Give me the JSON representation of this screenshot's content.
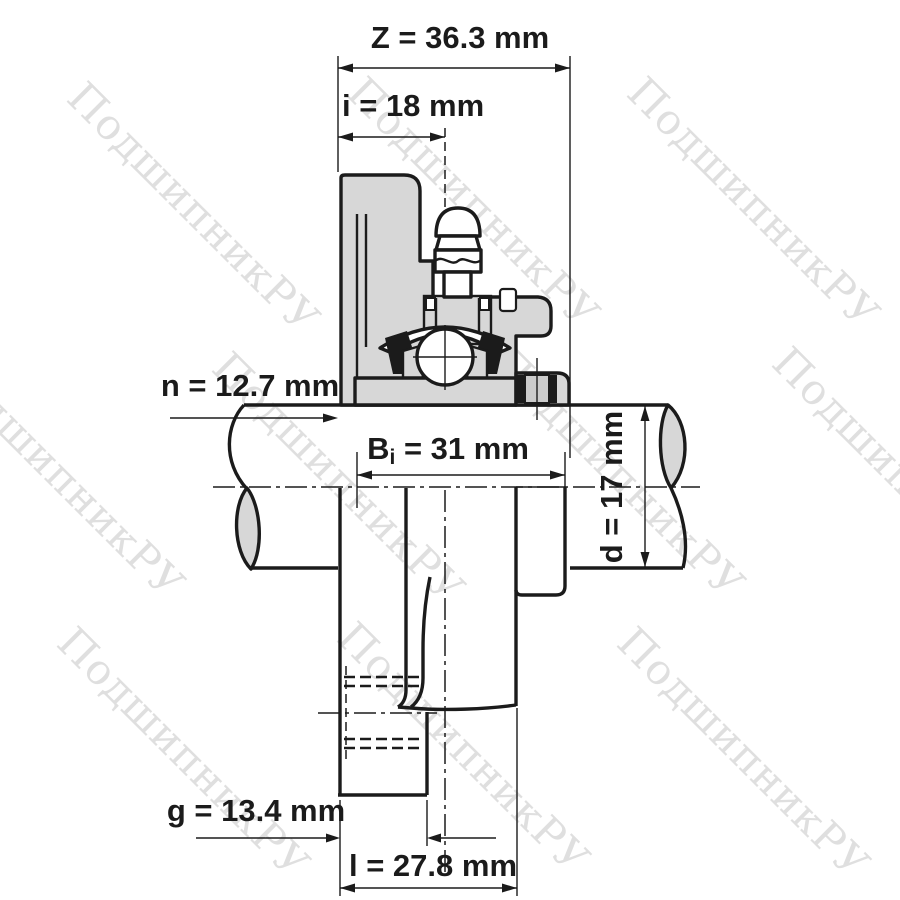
{
  "drawing_title": "Flanged bearing unit cross-section drawing",
  "watermark": {
    "text": "ПодшипникРУ"
  },
  "colors": {
    "line": "#1b1b1b",
    "section_fill": "#d7d7d7",
    "screw_mid": "#cbcbcb",
    "watermark": "#c9c9c9",
    "background": "#ffffff"
  },
  "dimensions": [
    {
      "id": "Z",
      "label": "Z = 36.3 mm",
      "value": 36.3,
      "unit": "mm"
    },
    {
      "id": "i",
      "label": "i = 18 mm",
      "value": 18,
      "unit": "mm"
    },
    {
      "id": "n",
      "label": "n = 12.7 mm",
      "value": 12.7,
      "unit": "mm"
    },
    {
      "id": "Bi",
      "prefix": "B",
      "subscript": "i",
      "suffix": " = 31 mm",
      "value": 31,
      "unit": "mm"
    },
    {
      "id": "d",
      "label": "d = 17 mm",
      "value": 17,
      "unit": "mm"
    },
    {
      "id": "g",
      "label": "g = 13.4 mm",
      "value": 13.4,
      "unit": "mm"
    },
    {
      "id": "l",
      "label": "l = 27.8 mm",
      "value": 27.8,
      "unit": "mm"
    }
  ]
}
